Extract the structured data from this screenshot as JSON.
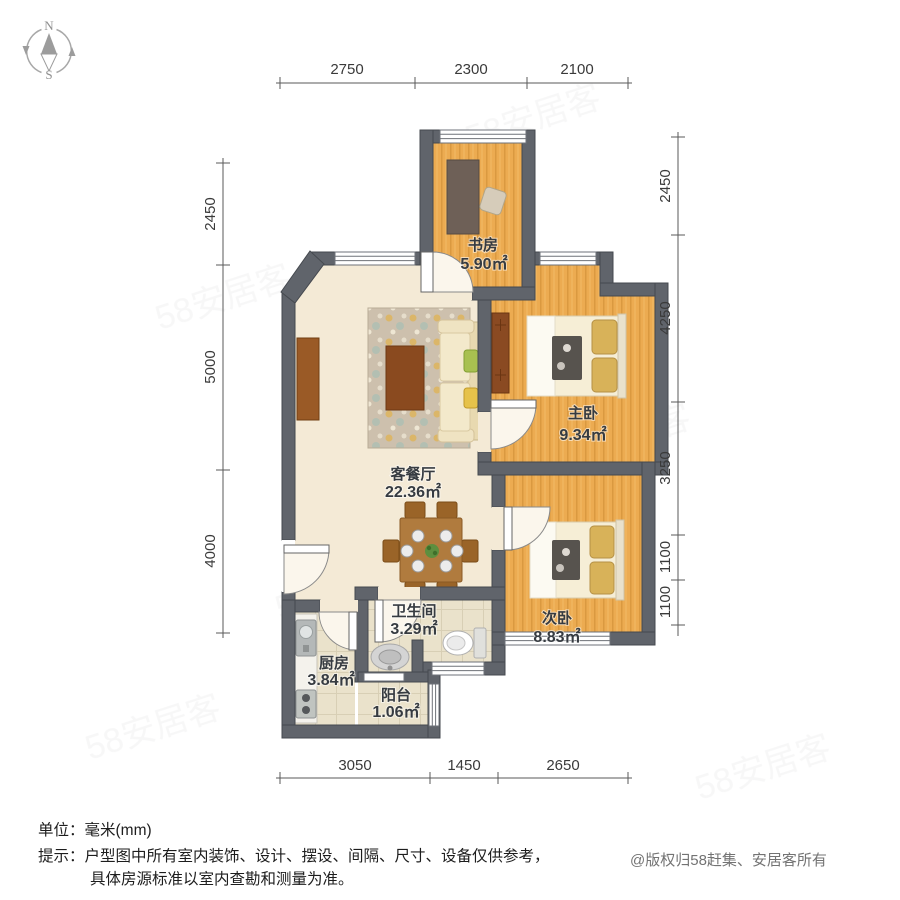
{
  "compass": {
    "north": "N",
    "south": "S"
  },
  "dimensions": {
    "top": [
      "2750",
      "2300",
      "2100"
    ],
    "bottom": [
      "3050",
      "1450",
      "2650"
    ],
    "left": [
      "2450",
      "5000",
      "4000"
    ],
    "right": [
      "2450",
      "4250",
      "3250",
      "1100",
      "1100"
    ]
  },
  "rooms": {
    "study": {
      "name": "书房",
      "area": "5.90㎡"
    },
    "master": {
      "name": "主卧",
      "area": "9.34㎡"
    },
    "living": {
      "name": "客餐厅",
      "area": "22.36㎡"
    },
    "second": {
      "name": "次卧",
      "area": "8.83㎡"
    },
    "bath": {
      "name": "卫生间",
      "area": "3.29㎡"
    },
    "kitchen": {
      "name": "厨房",
      "area": "3.84㎡"
    },
    "balcony": {
      "name": "阳台",
      "area": "1.06㎡"
    }
  },
  "footer": {
    "unit": "单位：毫米(mm)",
    "tip_line1": "提示：户型图中所有室内装饰、设计、摆设、间隔、尺寸、设备仅供参考，",
    "tip_line2": "具体房源标准以室内查勘和测量为准。",
    "copyright": "@版权归58赶集、安居客所有"
  },
  "watermark": {
    "text": "58安居客"
  },
  "colors": {
    "wall": "#60646b",
    "wood_floor": "#ecab51",
    "living_floor": "#f4ead6",
    "tile_floor": "#eae2cb",
    "furniture_wood": "#9a5a26",
    "dimension_text": "#3a3a3a"
  }
}
